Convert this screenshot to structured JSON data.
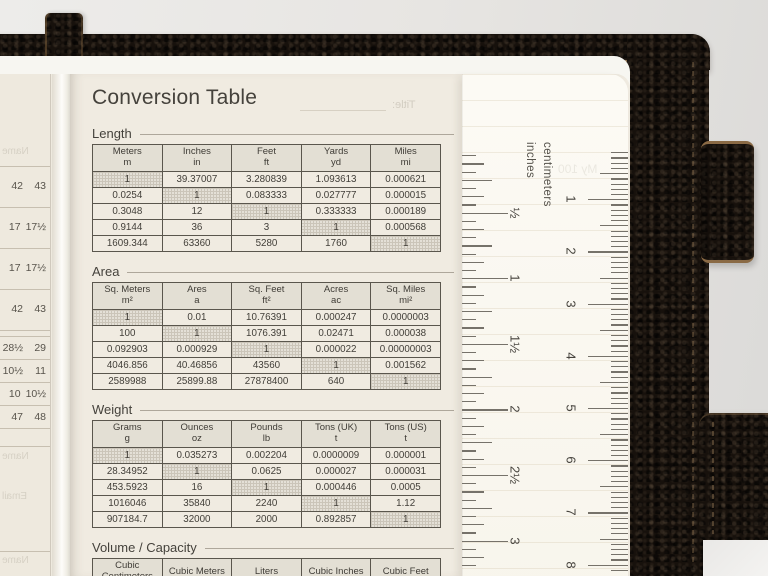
{
  "page_title": "Conversion Table",
  "sections": [
    {
      "label": "Length",
      "columns": [
        [
          "Meters",
          "m"
        ],
        [
          "Inches",
          "in"
        ],
        [
          "Feet",
          "ft"
        ],
        [
          "Yards",
          "yd"
        ],
        [
          "Miles",
          "mi"
        ]
      ],
      "rows": [
        [
          "1",
          "39.37007",
          "3.280839",
          "1.093613",
          "0.000621"
        ],
        [
          "0.0254",
          "1",
          "0.083333",
          "0.027777",
          "0.000015"
        ],
        [
          "0.3048",
          "12",
          "1",
          "0.333333",
          "0.000189"
        ],
        [
          "0.9144",
          "36",
          "3",
          "1",
          "0.000568"
        ],
        [
          "1609.344",
          "63360",
          "5280",
          "1760",
          "1"
        ]
      ]
    },
    {
      "label": "Area",
      "columns": [
        [
          "Sq. Meters",
          "m²"
        ],
        [
          "Ares",
          "a"
        ],
        [
          "Sq. Feet",
          "ft²"
        ],
        [
          "Acres",
          "ac"
        ],
        [
          "Sq. Miles",
          "mi²"
        ]
      ],
      "rows": [
        [
          "1",
          "0.01",
          "10.76391",
          "0.000247",
          "0.0000003"
        ],
        [
          "100",
          "1",
          "1076.391",
          "0.02471",
          "0.000038"
        ],
        [
          "0.092903",
          "0.000929",
          "1",
          "0.000022",
          "0.00000003"
        ],
        [
          "4046.856",
          "40.46856",
          "43560",
          "1",
          "0.001562"
        ],
        [
          "2589988",
          "25899.88",
          "27878400",
          "640",
          "1"
        ]
      ]
    },
    {
      "label": "Weight",
      "columns": [
        [
          "Grams",
          "g"
        ],
        [
          "Ounces",
          "oz"
        ],
        [
          "Pounds",
          "lb"
        ],
        [
          "Tons (UK)",
          "t"
        ],
        [
          "Tons (US)",
          "t"
        ]
      ],
      "rows": [
        [
          "1",
          "0.035273",
          "0.002204",
          "0.0000009",
          "0.000001"
        ],
        [
          "28.34952",
          "1",
          "0.0625",
          "0.000027",
          "0.000031"
        ],
        [
          "453.5923",
          "16",
          "1",
          "0.000446",
          "0.0005"
        ],
        [
          "1016046",
          "35840",
          "2240",
          "1",
          "1.12"
        ],
        [
          "907184.7",
          "32000",
          "2000",
          "0.892857",
          "1"
        ]
      ]
    },
    {
      "label": "Volume / Capacity",
      "columns": [
        [
          "Cubic Centimeters",
          ""
        ],
        [
          "Cubic Meters",
          ""
        ],
        [
          "Liters",
          ""
        ],
        [
          "Cubic Inches",
          ""
        ],
        [
          "Cubic Feet",
          ""
        ]
      ],
      "rows": []
    }
  ],
  "left_page": {
    "size_rows": [
      [
        "42",
        "43"
      ],
      [
        "17",
        "17½"
      ],
      [
        "17",
        "17½"
      ],
      [
        "42",
        "43"
      ],
      [
        "28½",
        "29"
      ],
      [
        "10½",
        "11"
      ],
      [
        "10",
        "10½"
      ],
      [
        "47",
        "48"
      ]
    ],
    "bleed_labels": [
      "Name",
      "Name",
      "Email",
      "Name"
    ]
  },
  "ruler": {
    "cm_label": "centimeters",
    "inch_label": "inches",
    "inch_marks": [
      "½",
      "1",
      "1½",
      "2",
      "2½",
      "3"
    ],
    "cm_marks": [
      "1",
      "2",
      "3",
      "4",
      "5",
      "6",
      "7",
      "8"
    ]
  },
  "bleed": {
    "title_label": "Title:",
    "page_heading": "My 100"
  },
  "colors": {
    "cover": "#17110c",
    "page": "#f0ebe1",
    "table_header_fill": "#e3dfd4",
    "shaded_cell_fill": "#cbc5b9",
    "ink": "#3e3b35"
  }
}
